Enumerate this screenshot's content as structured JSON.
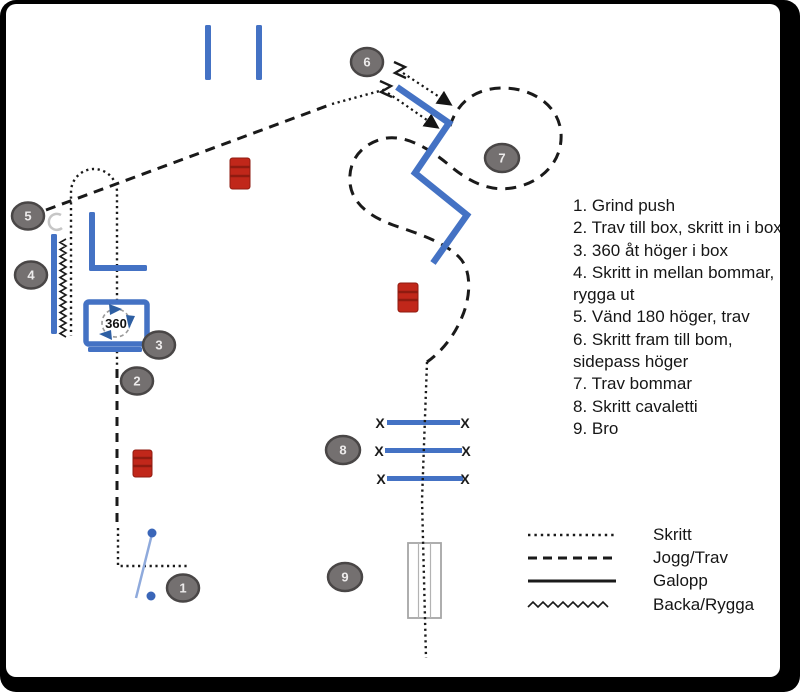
{
  "diagram": {
    "title_present": false,
    "markers": [
      {
        "label": "1"
      },
      {
        "label": "2"
      },
      {
        "label": "3"
      },
      {
        "label": "4"
      },
      {
        "label": "5"
      },
      {
        "label": "6"
      },
      {
        "label": "7"
      },
      {
        "label": "8"
      },
      {
        "label": "9"
      }
    ],
    "box360_label": "360",
    "cavaletti_mark": "X",
    "instructions": [
      "1. Grind push",
      "2. Trav till box, skritt in i box",
      "3. 360 åt höger i box",
      "4. Skritt in mellan bommar,",
      "rygga ut",
      "5. Vänd 180 höger, trav",
      "6. Skritt fram till bom,",
      "sidepass höger",
      "7. Trav bommar",
      "8. Skritt cavaletti",
      "9. Bro"
    ],
    "legend": [
      {
        "style": "dotted",
        "label": "Skritt"
      },
      {
        "style": "dashed",
        "label": "Jogg/Trav"
      },
      {
        "style": "solid",
        "label": "Galopp"
      },
      {
        "style": "zigzag",
        "label": "Backa/Rygga"
      }
    ],
    "colors": {
      "pole_blue": "#4472C4",
      "gate_blue": "#8FAADC",
      "barrel_red": "#C1271A",
      "barrel_band": "#8F1B10",
      "marker_gray": "#747070",
      "marker_border": "#494646",
      "line_black": "#1a1a1a",
      "frame_black": "#000000"
    }
  }
}
